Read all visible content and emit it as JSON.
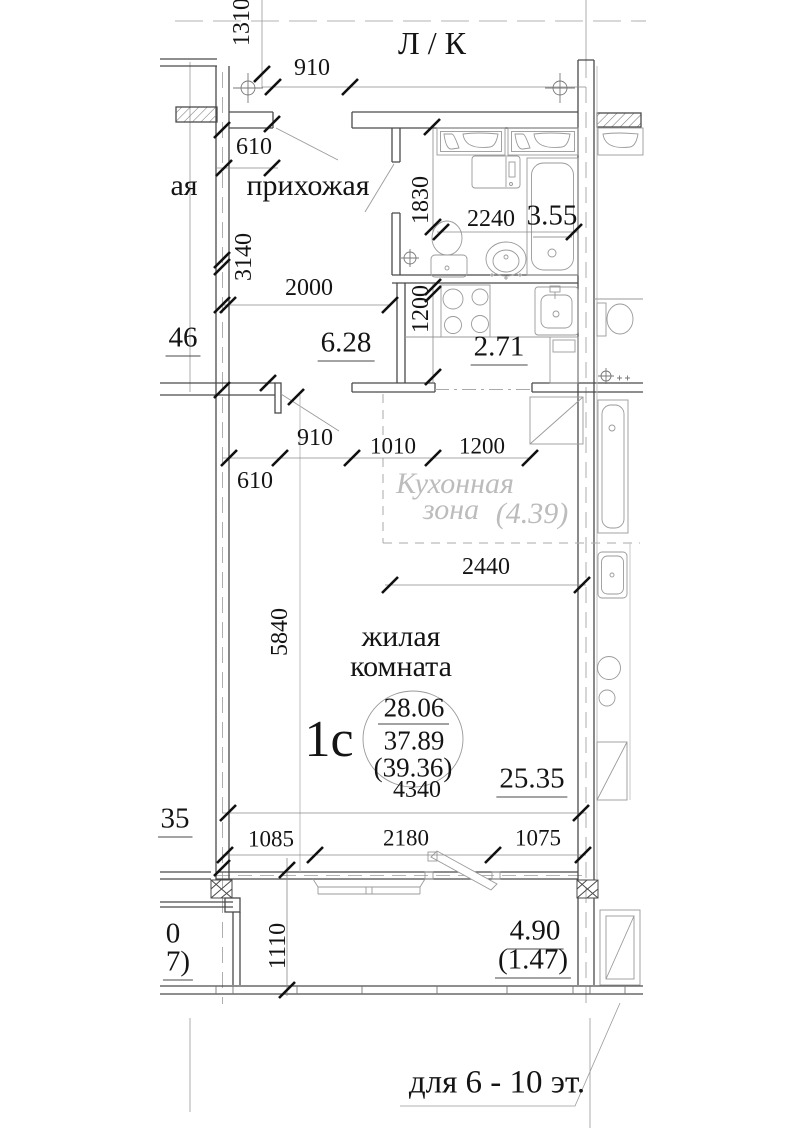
{
  "plan_title": "Floor plan of studio apartment 1с",
  "labels": {
    "stairwell": "Л / К",
    "hallway": "прихожая",
    "living1": "жилая",
    "living2": "комната",
    "kz1": "Кухонная",
    "kz2": "зона",
    "kz_area": "(4.39)",
    "apt_type": "1с",
    "area_living": "28.06",
    "area_total": "37.89",
    "area_total2": "(39.36)",
    "hall_area": "6.28",
    "bath_area": "3.55",
    "kitchen_area": "2.71",
    "room_area": "25.35",
    "balc_area": "4.90",
    "balc_area2": "(1.47)",
    "note": "для 6 - 10 эт.",
    "partial_room_suffix": "ая",
    "partial_area_46": "46",
    "partial_area_35": "35",
    "partial_area_0": "0",
    "partial_area_7": "7)"
  },
  "dims": {
    "d1310": "1310",
    "d910a": "910",
    "d610a": "610",
    "d3140": "3140",
    "d2000": "2000",
    "d1830": "1830",
    "d2240": "2240",
    "d1200k": "1200",
    "d910b": "910",
    "d1010": "1010",
    "d1200z": "1200",
    "d610b": "610",
    "d2440": "2440",
    "d5840": "5840",
    "d4340": "4340",
    "d1085": "1085",
    "d2180": "2180",
    "d1075": "1075",
    "d1110": "1110"
  },
  "colors": {
    "wall_line": "#4a4a4a",
    "fixture_line": "#9a9a9a",
    "dim_line": "#8a8a8a",
    "tick": "#111111",
    "gray_text": "#bcbcbc",
    "text": "#141414",
    "background": "#ffffff"
  }
}
